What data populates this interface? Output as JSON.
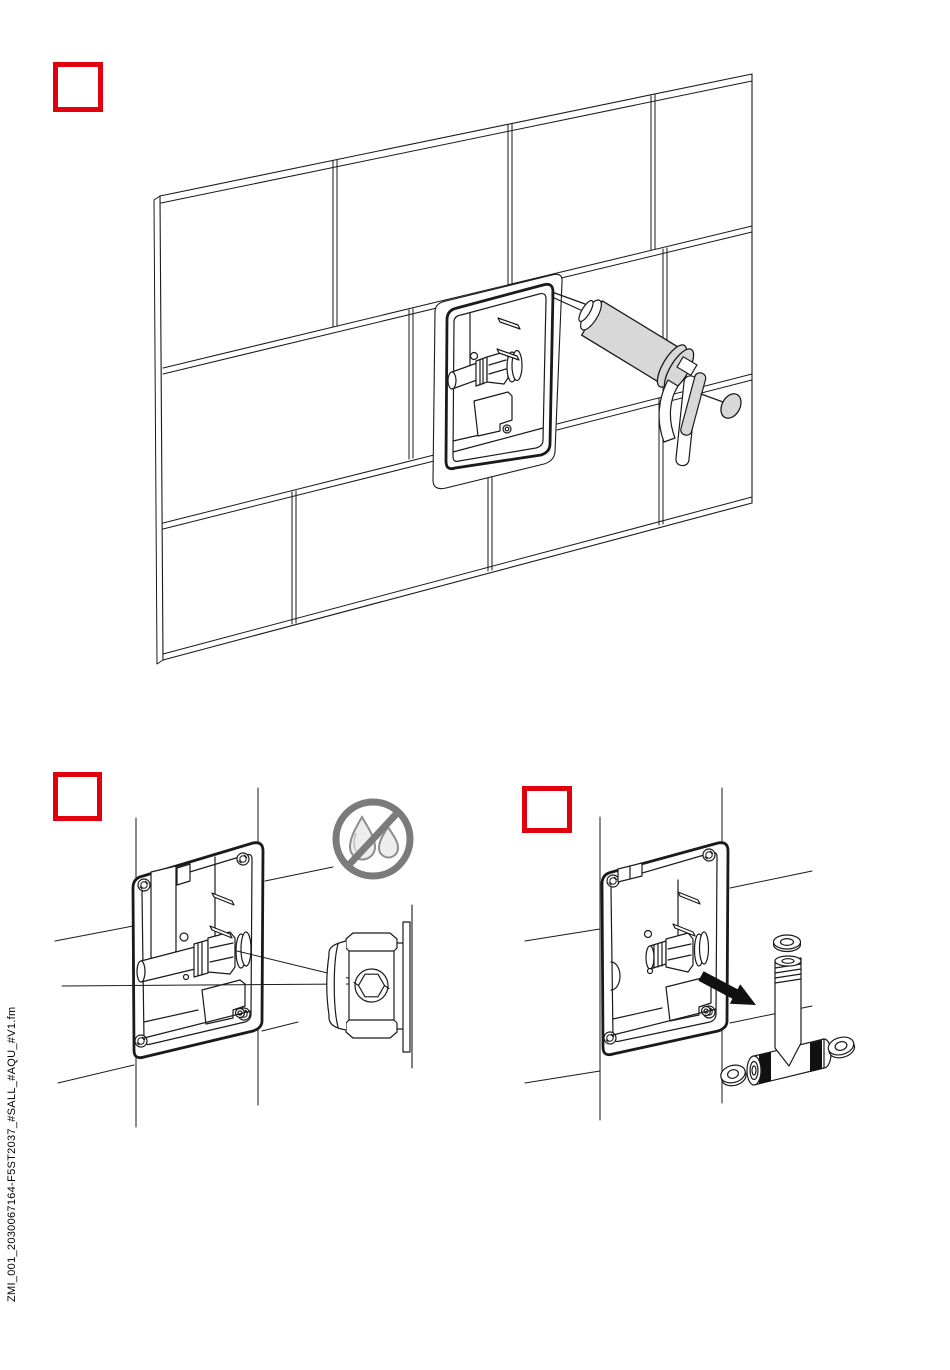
{
  "page": {
    "width": 950,
    "height": 1370,
    "background": "#ffffff",
    "side_label": "ZMI_001_2030067164-F5ST2037_#SALL_#AQU_#V1.fm"
  },
  "colors": {
    "step_box_red": "#e2000f",
    "line": "#1a1a1a",
    "tool_gray": "#d8d8d8",
    "prohibition_gray": "#7b7b7b",
    "arrow_black": "#111111"
  },
  "steps": [
    {
      "label": ""
    },
    {
      "label": ""
    },
    {
      "label": ""
    }
  ],
  "icons": [
    "no-water-drops-icon",
    "direction-arrow-icon"
  ]
}
